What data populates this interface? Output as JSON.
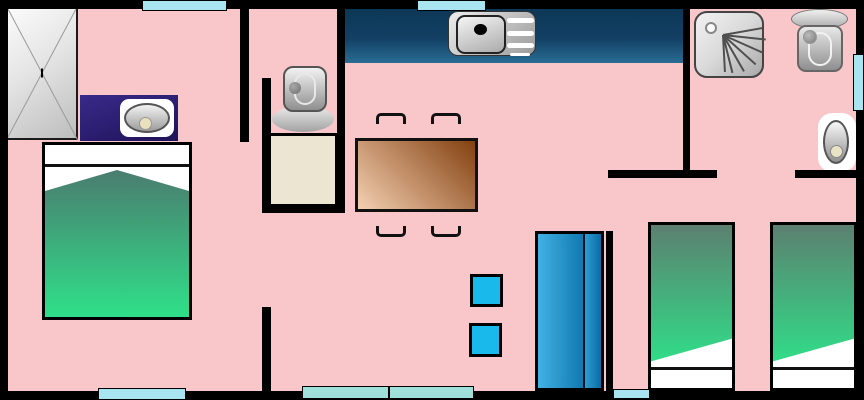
{
  "floorplan": {
    "kind": "mobile-home-floor-plan",
    "canvas": {
      "width": 864,
      "height": 400
    },
    "colors": {
      "floor": "#f9c7ca",
      "wall": "#000000",
      "window": "#a9e4f1",
      "window_patio": "#9fe0da",
      "counter_dark": "#0c3756",
      "counter_light": "#2a6d94",
      "vanity": "#2a1c72",
      "table_light": "#f4d0b2",
      "table_dark": "#83400f",
      "blanket_dark": "#4b7a6f",
      "blanket_dark2": "#5c8070",
      "blanket_light": "#2fe089",
      "fridge_light": "#41b1e4",
      "fridge_dark": "#0d6aa4",
      "stool": "#1ab9ec",
      "cabinet_beige": "#ece5d2"
    },
    "walls": [
      {
        "name": "wall-outer-top",
        "x": 0,
        "y": 0,
        "w": 864,
        "h": 9
      },
      {
        "name": "wall-outer-bottom",
        "x": 0,
        "y": 391,
        "w": 864,
        "h": 9
      },
      {
        "name": "wall-outer-left",
        "x": 0,
        "y": 0,
        "w": 8,
        "h": 400
      },
      {
        "name": "wall-outer-right",
        "x": 856,
        "y": 0,
        "w": 8,
        "h": 400
      },
      {
        "name": "wall-bedroom1-upper",
        "x": 240,
        "y": 9,
        "w": 9,
        "h": 133
      },
      {
        "name": "wall-wc-left",
        "x": 262,
        "y": 78,
        "w": 9,
        "h": 135
      },
      {
        "name": "wall-wc-right",
        "x": 337,
        "y": 0,
        "w": 8,
        "h": 213
      },
      {
        "name": "wall-wc-bottom",
        "x": 262,
        "y": 206,
        "w": 83,
        "h": 7
      },
      {
        "name": "wall-bedroom1-lower",
        "x": 262,
        "y": 307,
        "w": 9,
        "h": 84
      },
      {
        "name": "wall-bathroom-left",
        "x": 683,
        "y": 0,
        "w": 7,
        "h": 178
      },
      {
        "name": "wall-hallway-left",
        "x": 608,
        "y": 170,
        "w": 109,
        "h": 8
      },
      {
        "name": "wall-hallway-right",
        "x": 795,
        "y": 170,
        "w": 61,
        "h": 8
      },
      {
        "name": "wall-bedroom2-left",
        "x": 606,
        "y": 231,
        "w": 7,
        "h": 160
      }
    ],
    "windows": [
      {
        "name": "window-top-bedroom1",
        "x": 142,
        "y": 0,
        "w": 85,
        "h": 11,
        "variant": "standard"
      },
      {
        "name": "window-top-kitchen",
        "x": 417,
        "y": 0,
        "w": 69,
        "h": 11,
        "variant": "standard"
      },
      {
        "name": "window-right-bathroom",
        "x": 853,
        "y": 54,
        "w": 11,
        "h": 57,
        "variant": "standard"
      },
      {
        "name": "window-bottom-bedroom1",
        "x": 98,
        "y": 388,
        "w": 88,
        "h": 12,
        "variant": "standard"
      },
      {
        "name": "window-bottom-living-left",
        "x": 302,
        "y": 386,
        "w": 87,
        "h": 13,
        "variant": "patio"
      },
      {
        "name": "window-bottom-living-right",
        "x": 389,
        "y": 386,
        "w": 85,
        "h": 13,
        "variant": "patio"
      },
      {
        "name": "door-bottom-bedroom2",
        "x": 613,
        "y": 389,
        "w": 37,
        "h": 10,
        "variant": "standard"
      }
    ],
    "furniture": [
      "wardrobe",
      "vanity-sink",
      "double-bed",
      "toilet-wc",
      "shower-tray-cabinet",
      "kitchen-counter",
      "kitchen-sink",
      "dining-table",
      "chair",
      "chair",
      "chair",
      "chair",
      "stool",
      "stool",
      "fridge",
      "shower",
      "toilet-bathroom",
      "washbasin",
      "single-bed",
      "single-bed"
    ]
  }
}
